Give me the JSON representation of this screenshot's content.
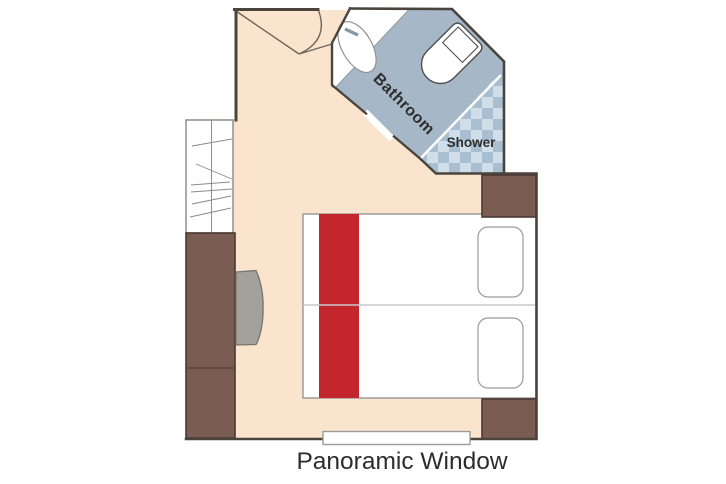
{
  "floorplan": {
    "labels": {
      "bathroom": "Bathroom",
      "shower": "Shower",
      "window": "Panoramic Window"
    }
  },
  "colors": {
    "floor_peach": "#fbe4cd",
    "bathroom_blue": "#a6b8c7",
    "tile_light": "#cfdee9",
    "tile_dark": "#a9bed0",
    "furniture_brown": "#7b5c52",
    "furniture_brown_border": "#4b3a33",
    "bed_runner_red": "#c4262e",
    "wall_dark": "#4a443d",
    "border_gray": "#8f8f8f",
    "chair_gray": "#a2a19b",
    "chair_border": "#75746d",
    "fixture_outline": "#4f4f4f",
    "text_dark": "#2d2d2d"
  }
}
